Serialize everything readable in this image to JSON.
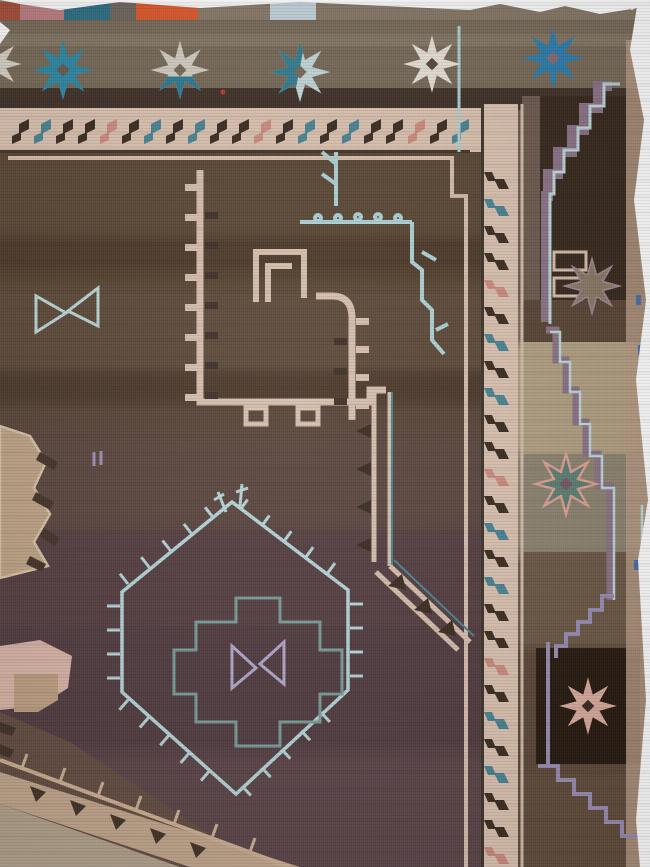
{
  "meta": {
    "subject": "Antique Anatolian kilim-woven carpet fragment, corner detail photograph",
    "view": "top-right corner of rug on white background"
  },
  "palette": {
    "cream": "#dcc3b1",
    "cream_guard": "#d8bfae",
    "dark_brown": "#3c2d22",
    "teal": "#4a8595",
    "light_blue": "#aed3d6",
    "pale_blue_line": "#b7d6d8",
    "teal_line": "#7b9c98",
    "lavender": "#b3a8cc",
    "mauve": "#8d7488",
    "lavender_line": "#9b8fb5",
    "pink": "#d9b4a7",
    "salmon": "#cf8d80",
    "camel": "#bfa487",
    "tan_band": "#c2a68c",
    "tan_tick": "#cdb093",
    "white_edge": "#ffffff",
    "field_brown": "#5c4836",
    "plum_brown": "#553f42",
    "margin_dark": "#38291e",
    "box_dark": "#281b11",
    "blue_dash": "#4a6fa8",
    "red_fleck": "#c0392b"
  },
  "selvedge": {
    "patches": [
      {
        "name": "red-patch",
        "color": "#a84f3a"
      },
      {
        "name": "rose-patch",
        "color": "#bd7f83"
      },
      {
        "name": "dark-teal-patch",
        "color": "#2e6f85"
      },
      {
        "name": "checkered-patch",
        "color": "#6e685e"
      },
      {
        "name": "orange-patch",
        "color": "#dd5a2d"
      },
      {
        "name": "taupe-weave",
        "color": "#897b6a"
      },
      {
        "name": "light-blue-patch",
        "color": "#c3d4dc"
      },
      {
        "name": "taupe-weave-2",
        "color": "#877968"
      }
    ]
  },
  "star_band": {
    "background": "#796b5a",
    "dark_band": "#41322a",
    "stars": [
      {
        "name": "teal-eight-point-star",
        "fill": "#2f8aa6",
        "center": "#6b5e50"
      },
      {
        "name": "silver-star-teal-base",
        "fill": "#d6cfc3",
        "accent": "#2e7d96",
        "center": "#7a6c5b"
      },
      {
        "name": "pale-blue-star-teal-left",
        "fill": "#c5d9db",
        "accent": "#357f93",
        "center": "#7a6c5b"
      },
      {
        "name": "white-star",
        "fill": "#e9e4da",
        "center": "#5a4a3c"
      },
      {
        "name": "blue-star",
        "fill": "#2f7fb0",
        "center": "#8a6b74"
      },
      {
        "name": "partial-star-left-edge",
        "fill": "#d9d3c7",
        "center": "#796b5a"
      }
    ]
  },
  "border": {
    "ground": "#dcc3b1",
    "guard": "#d8bfae",
    "seam": "#463528",
    "hook_colors": [
      "#3c2d22",
      "#4a8595",
      "#3c2d22",
      "#3c2d22",
      "#cf8d80",
      "#3c2d22",
      "#4a8595"
    ]
  },
  "field_motifs": {
    "hooked_band_color": "#d7bfae",
    "hooked_band_dark": "#40302a",
    "vine_color": "#aed3d6",
    "bowtie_color": "#bcd8da",
    "hexagon_color": "#b7d6d8",
    "stepped_medallion_color": "#7b9c98",
    "center_bowtie_color": "#b3a8cc",
    "camel_medallion": "#bfa487",
    "camel_outline": "#d9c3a8"
  },
  "margin_motifs": {
    "stepped_band": "#8d7488",
    "stepped_edge": "#bfd9db",
    "lavender_steps": "#9b8fb5",
    "cream_bars": "#d8c0ae",
    "stars": [
      {
        "name": "faded-camel-star",
        "fill": "#8a7a64",
        "stroke": "#9f8692"
      },
      {
        "name": "teal-star-pink-outline",
        "fill": "#5d8174",
        "stroke": "#e2a394",
        "center": "#7c5966"
      },
      {
        "name": "pink-star",
        "fill": "#dcae9f",
        "center": "#3a2b20"
      }
    ]
  }
}
